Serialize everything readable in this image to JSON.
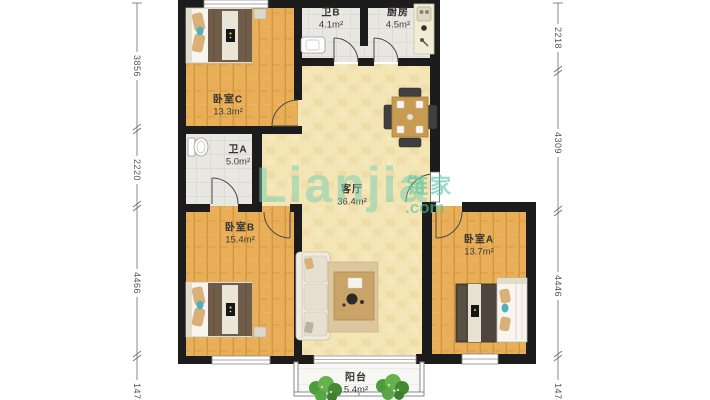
{
  "floorplan": {
    "watermark": {
      "latin": "Lianjia",
      "cjk": "链家",
      "tld": ".com"
    },
    "rooms": [
      {
        "key": "bedroom-c",
        "label": "卧室C",
        "area": "13.3m²"
      },
      {
        "key": "bath-b",
        "label": "卫B",
        "area": "4.1m²"
      },
      {
        "key": "kitchen",
        "label": "厨房",
        "area": "4.5m²"
      },
      {
        "key": "bath-a",
        "label": "卫A",
        "area": "5.0m²"
      },
      {
        "key": "living-room",
        "label": "客厅",
        "area": "36.4m²"
      },
      {
        "key": "bedroom-b",
        "label": "卧室B",
        "area": "15.4m²"
      },
      {
        "key": "bedroom-a",
        "label": "卧室A",
        "area": "13.7m²"
      },
      {
        "key": "balcony",
        "label": "阳台",
        "area": "5.4m²"
      }
    ],
    "dimensions_mm": {
      "left": [
        "3856",
        "2220",
        "4466",
        "1474"
      ],
      "right": [
        "2218",
        "4309",
        "4446",
        "1474"
      ]
    },
    "colors": {
      "wall": "#1C1C1C",
      "bedroom_floor": "#E8AE58",
      "living_floor": "#F3E5B4",
      "wet_room_floor": "#E9E7E2",
      "balcony_floor": "#F7F8F3",
      "watermark_teal": "#5FC3A2",
      "plant_green": "#5BA644"
    }
  }
}
